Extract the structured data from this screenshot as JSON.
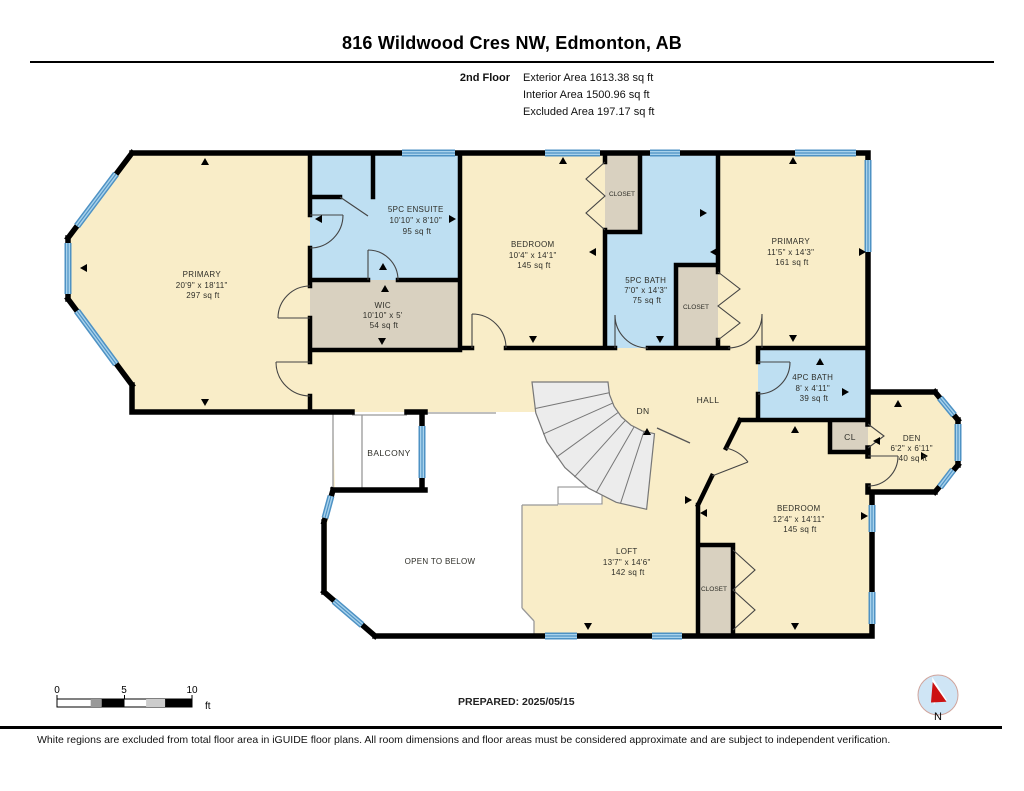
{
  "header": {
    "title": "816 Wildwood Cres NW, Edmonton, AB",
    "floor_label": "2nd Floor",
    "stats": [
      "Exterior Area 1613.38 sq ft",
      "Interior Area 1500.96 sq ft",
      "Excluded Area 197.17 sq ft"
    ]
  },
  "rooms": {
    "primary_left": {
      "name": "PRIMARY",
      "dims": "20'9\" x 18'11\"",
      "area": "297 sq ft"
    },
    "ensuite": {
      "name": "5PC ENSUITE",
      "dims": "10'10\" x 8'10\"",
      "area": "95 sq ft"
    },
    "wic": {
      "name": "WIC",
      "dims": "10'10\" x 5'",
      "area": "54 sq ft"
    },
    "bedroom_top": {
      "name": "BEDROOM",
      "dims": "10'4\" x 14'1\"",
      "area": "145 sq ft"
    },
    "bath5": {
      "name": "5PC BATH",
      "dims": "7'0\" x 14'3\"",
      "area": "75 sq ft"
    },
    "primary_right": {
      "name": "PRIMARY",
      "dims": "11'5\" x 14'3\"",
      "area": "161 sq ft"
    },
    "bath4": {
      "name": "4PC BATH",
      "dims": "8' x 4'11\"",
      "area": "39 sq ft"
    },
    "den": {
      "name": "DEN",
      "dims": "6'2\" x 6'11\"",
      "area": "40 sq ft"
    },
    "bedroom_bottom": {
      "name": "BEDROOM",
      "dims": "12'4\" x 14'11\"",
      "area": "145 sq ft"
    },
    "loft": {
      "name": "LOFT",
      "dims": "13'7\" x 14'6\"",
      "area": "142 sq ft"
    },
    "closet_top": {
      "name": "CLOSET"
    },
    "closet_mid": {
      "name": "CLOSET"
    },
    "closet_bottom": {
      "name": "CLOSET"
    },
    "cl": {
      "name": "CL"
    },
    "hall": {
      "name": "HALL"
    },
    "dn": {
      "name": "DN"
    },
    "balcony": {
      "name": "BALCONY"
    },
    "open_below": {
      "name": "OPEN TO BELOW"
    }
  },
  "scale": {
    "ticks": [
      "0",
      "5",
      "10"
    ],
    "unit": "ft"
  },
  "prepared": "PREPARED: 2025/05/15",
  "compass": {
    "label": "N"
  },
  "disclaimer": "White regions are excluded from total floor area in iGUIDE floor plans. All room dimensions and floor areas must be considered approximate and are subject to independent verification.",
  "colors": {
    "room_fill": "#f9edc8",
    "wet_room_fill": "#bedff2",
    "closet_fill": "#d9d1c0",
    "window_blue": "#4e92c4",
    "wall": "#000000",
    "open_area": "#ffffff",
    "compass_fill": "#cfe5f5",
    "compass_needle": "#cc1111"
  }
}
